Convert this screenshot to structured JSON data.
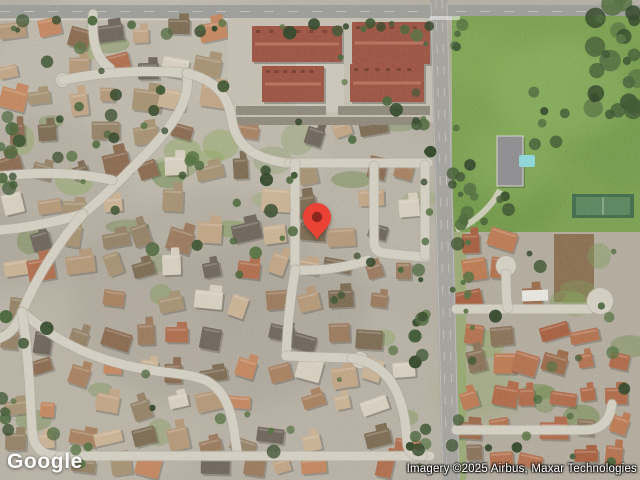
{
  "map": {
    "view_type": "satellite",
    "google_logo": "Google",
    "attribution": "Imagery ©2025 Airbus, Maxar Technologies",
    "marker": {
      "name": "location-pin",
      "x": 317,
      "y": 240,
      "color": "#EA4335",
      "dot_color": "#8E2620"
    },
    "terrain_palette": {
      "base": "#b5afa2",
      "base_right": "#b3ac9e",
      "street": "#d4d0c3",
      "street_edge": "#b0aa9c",
      "main_road": "#a5a39e",
      "top_road": "#9d9d99",
      "field_green": "#7aa14f",
      "lawn_greens": [
        "#7e9a58",
        "#6d8a49",
        "#8fa862"
      ],
      "tree_greens": [
        "#3c5530",
        "#2f4526",
        "#486538",
        "#54713f"
      ],
      "roofs_left": [
        "#b59878",
        "#a8815f",
        "#c2a585",
        "#9b7a5d",
        "#8a6a4f",
        "#b06d4c",
        "#c4875f",
        "#a79272",
        "#958266",
        "#cbb394",
        "#7d6b52",
        "#d8d0c0",
        "#6e655a"
      ],
      "roofs_right": [
        "#b06a48",
        "#a85f3f",
        "#bd7a52",
        "#9c6a4a",
        "#8a7258",
        "#b4714e"
      ],
      "apartment_roof": "#9d5240",
      "apartment_ridge": "#b9705c",
      "garage_roof": "#8f897b",
      "dirt": "#8a6f50",
      "pool": "#8fd8dc",
      "mansion_roof": "#8e8e90",
      "tennis_court": "#3f6b4a",
      "shed_white": "#e9e7e1"
    }
  }
}
